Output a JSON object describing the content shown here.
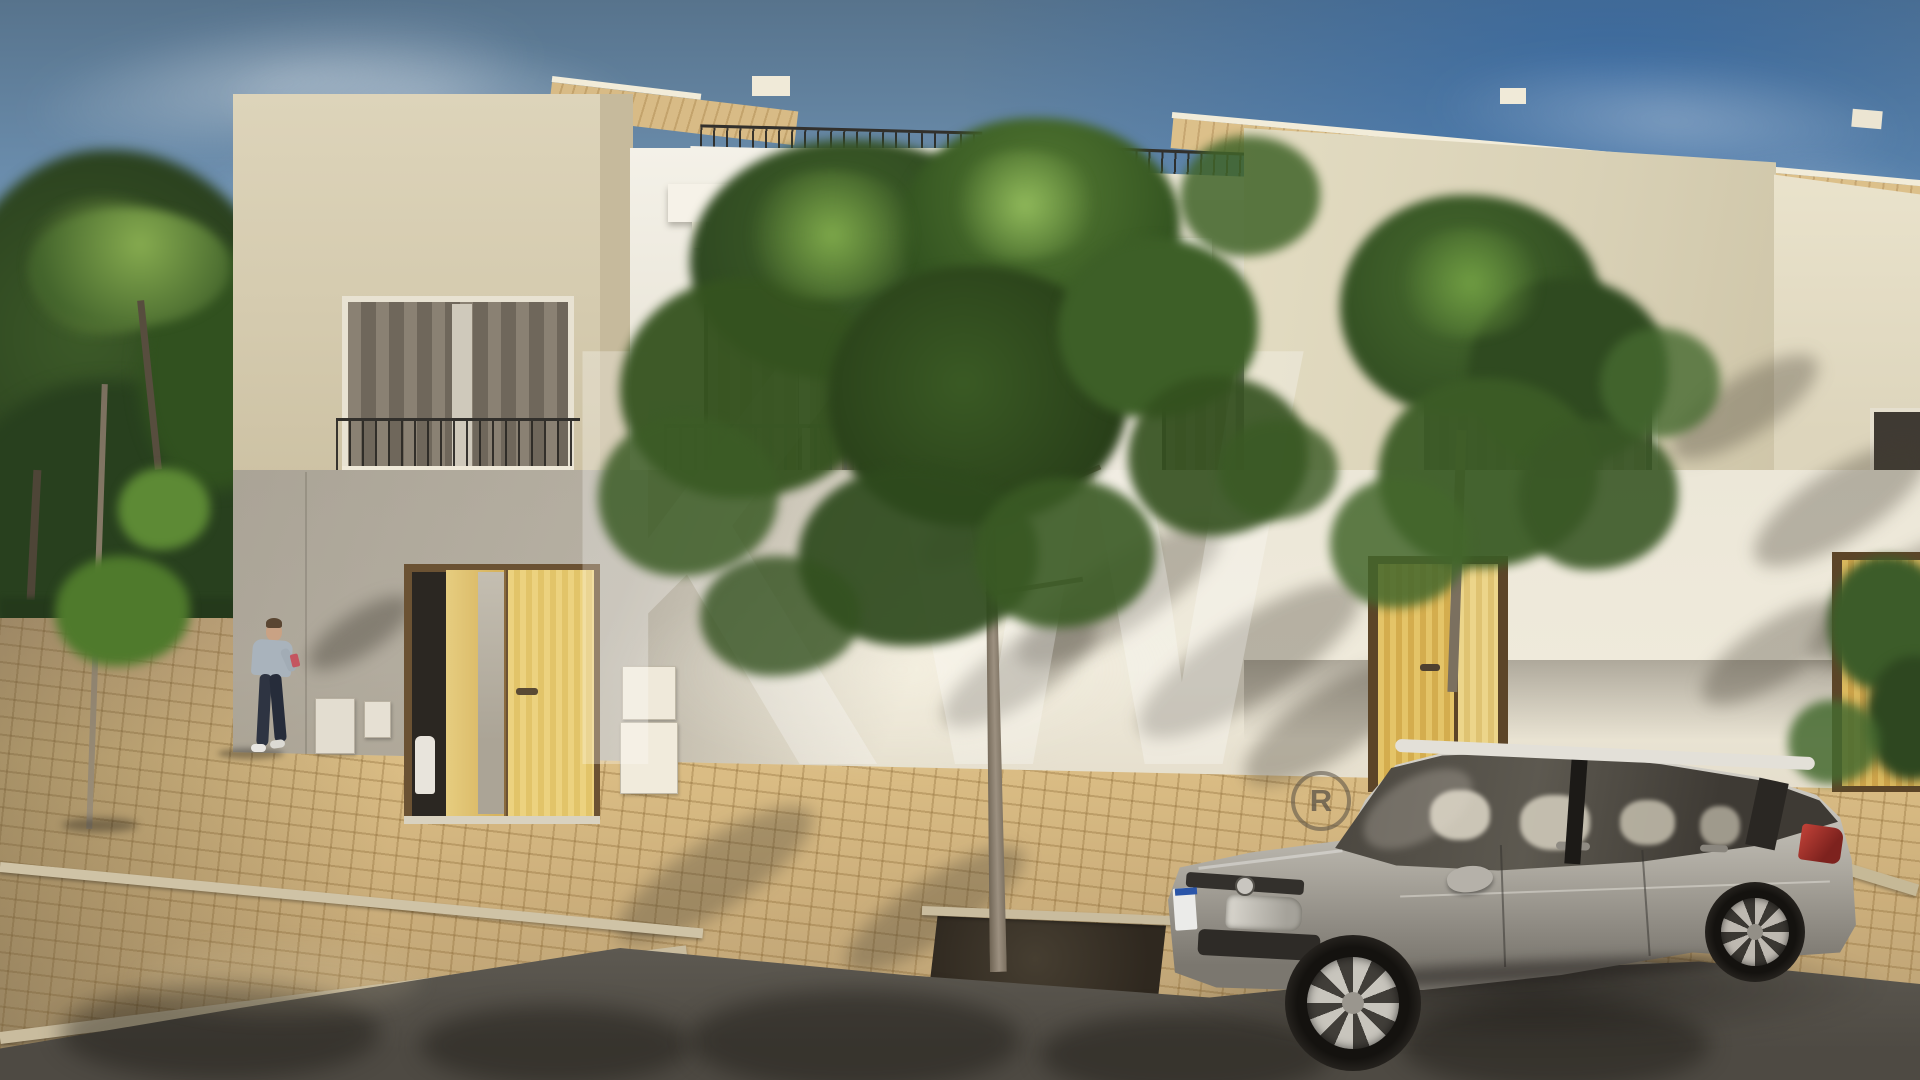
{
  "image": {
    "kind": "architectural-exterior-render",
    "description": "3D render of a modern two-storey cream townhouse row with juliet balconies and pergolas, light oak front doors, a slim street tree, a pedestrian checking a phone, Portuguese cobblestone sidewalk, asphalt street and a parked silver hatchback, under a blue sky",
    "width_px": 1920,
    "height_px": 1080
  },
  "watermark": {
    "letters": "KW",
    "registered": "R",
    "color": "#ffffff",
    "opacity": 0.28
  },
  "palette": {
    "sky_top": "#57738c",
    "sky_mid": "#7b9fc0",
    "sky_deep_right": "#3f74ad",
    "sky_horizon": "#aecde2",
    "facade_beige": "#d8cfb4",
    "facade_white": "#f2efe6",
    "facade_cream": "#ddd5ba",
    "facade_shadow": "#a8a094",
    "roof_wood": "#d5b87e",
    "door_oak": "#e6cb72",
    "door_frame": "#6b5233",
    "railing_dark": "#32302c",
    "railing_gray": "#6d6963",
    "curtain_gray": "#958c7d",
    "opening_dark": "#4a453e",
    "cobble_sunlit": "#d9b97e",
    "cobble_shaded": "#9d8f78",
    "kerb_stone": "#cfc3a6",
    "asphalt": "#55514b",
    "tree_pit_soil": "#3a332a",
    "foliage_dark": "#2c4420",
    "foliage_mid": "#47682e",
    "foliage_light": "#7da74a",
    "trunk_gray": "#8d8170",
    "car_silver": "#b6b2aa",
    "car_glass": "#46423b",
    "plate_blue_band": "#2a55a8",
    "taillight_red": "#a92f27",
    "person_shirt": "#a9b3bc",
    "person_pants": "#2e3442",
    "person_skin": "#c9a284",
    "person_phone": "#c45560"
  },
  "objects": [
    "sky",
    "clouds",
    "left-trees",
    "street-sapling",
    "pedestrian",
    "side-street",
    "cobble-plaza",
    "kerbs",
    "main-road",
    "townhouse-row",
    "wood-slat-roof",
    "roof-terrace-railings",
    "juliet-balconies",
    "pergolas",
    "oak-entry-doors",
    "wall-panels",
    "foreground-tree",
    "tree-pit",
    "utility-box",
    "silver-hatchback",
    "right-tree",
    "kw-watermark"
  ]
}
